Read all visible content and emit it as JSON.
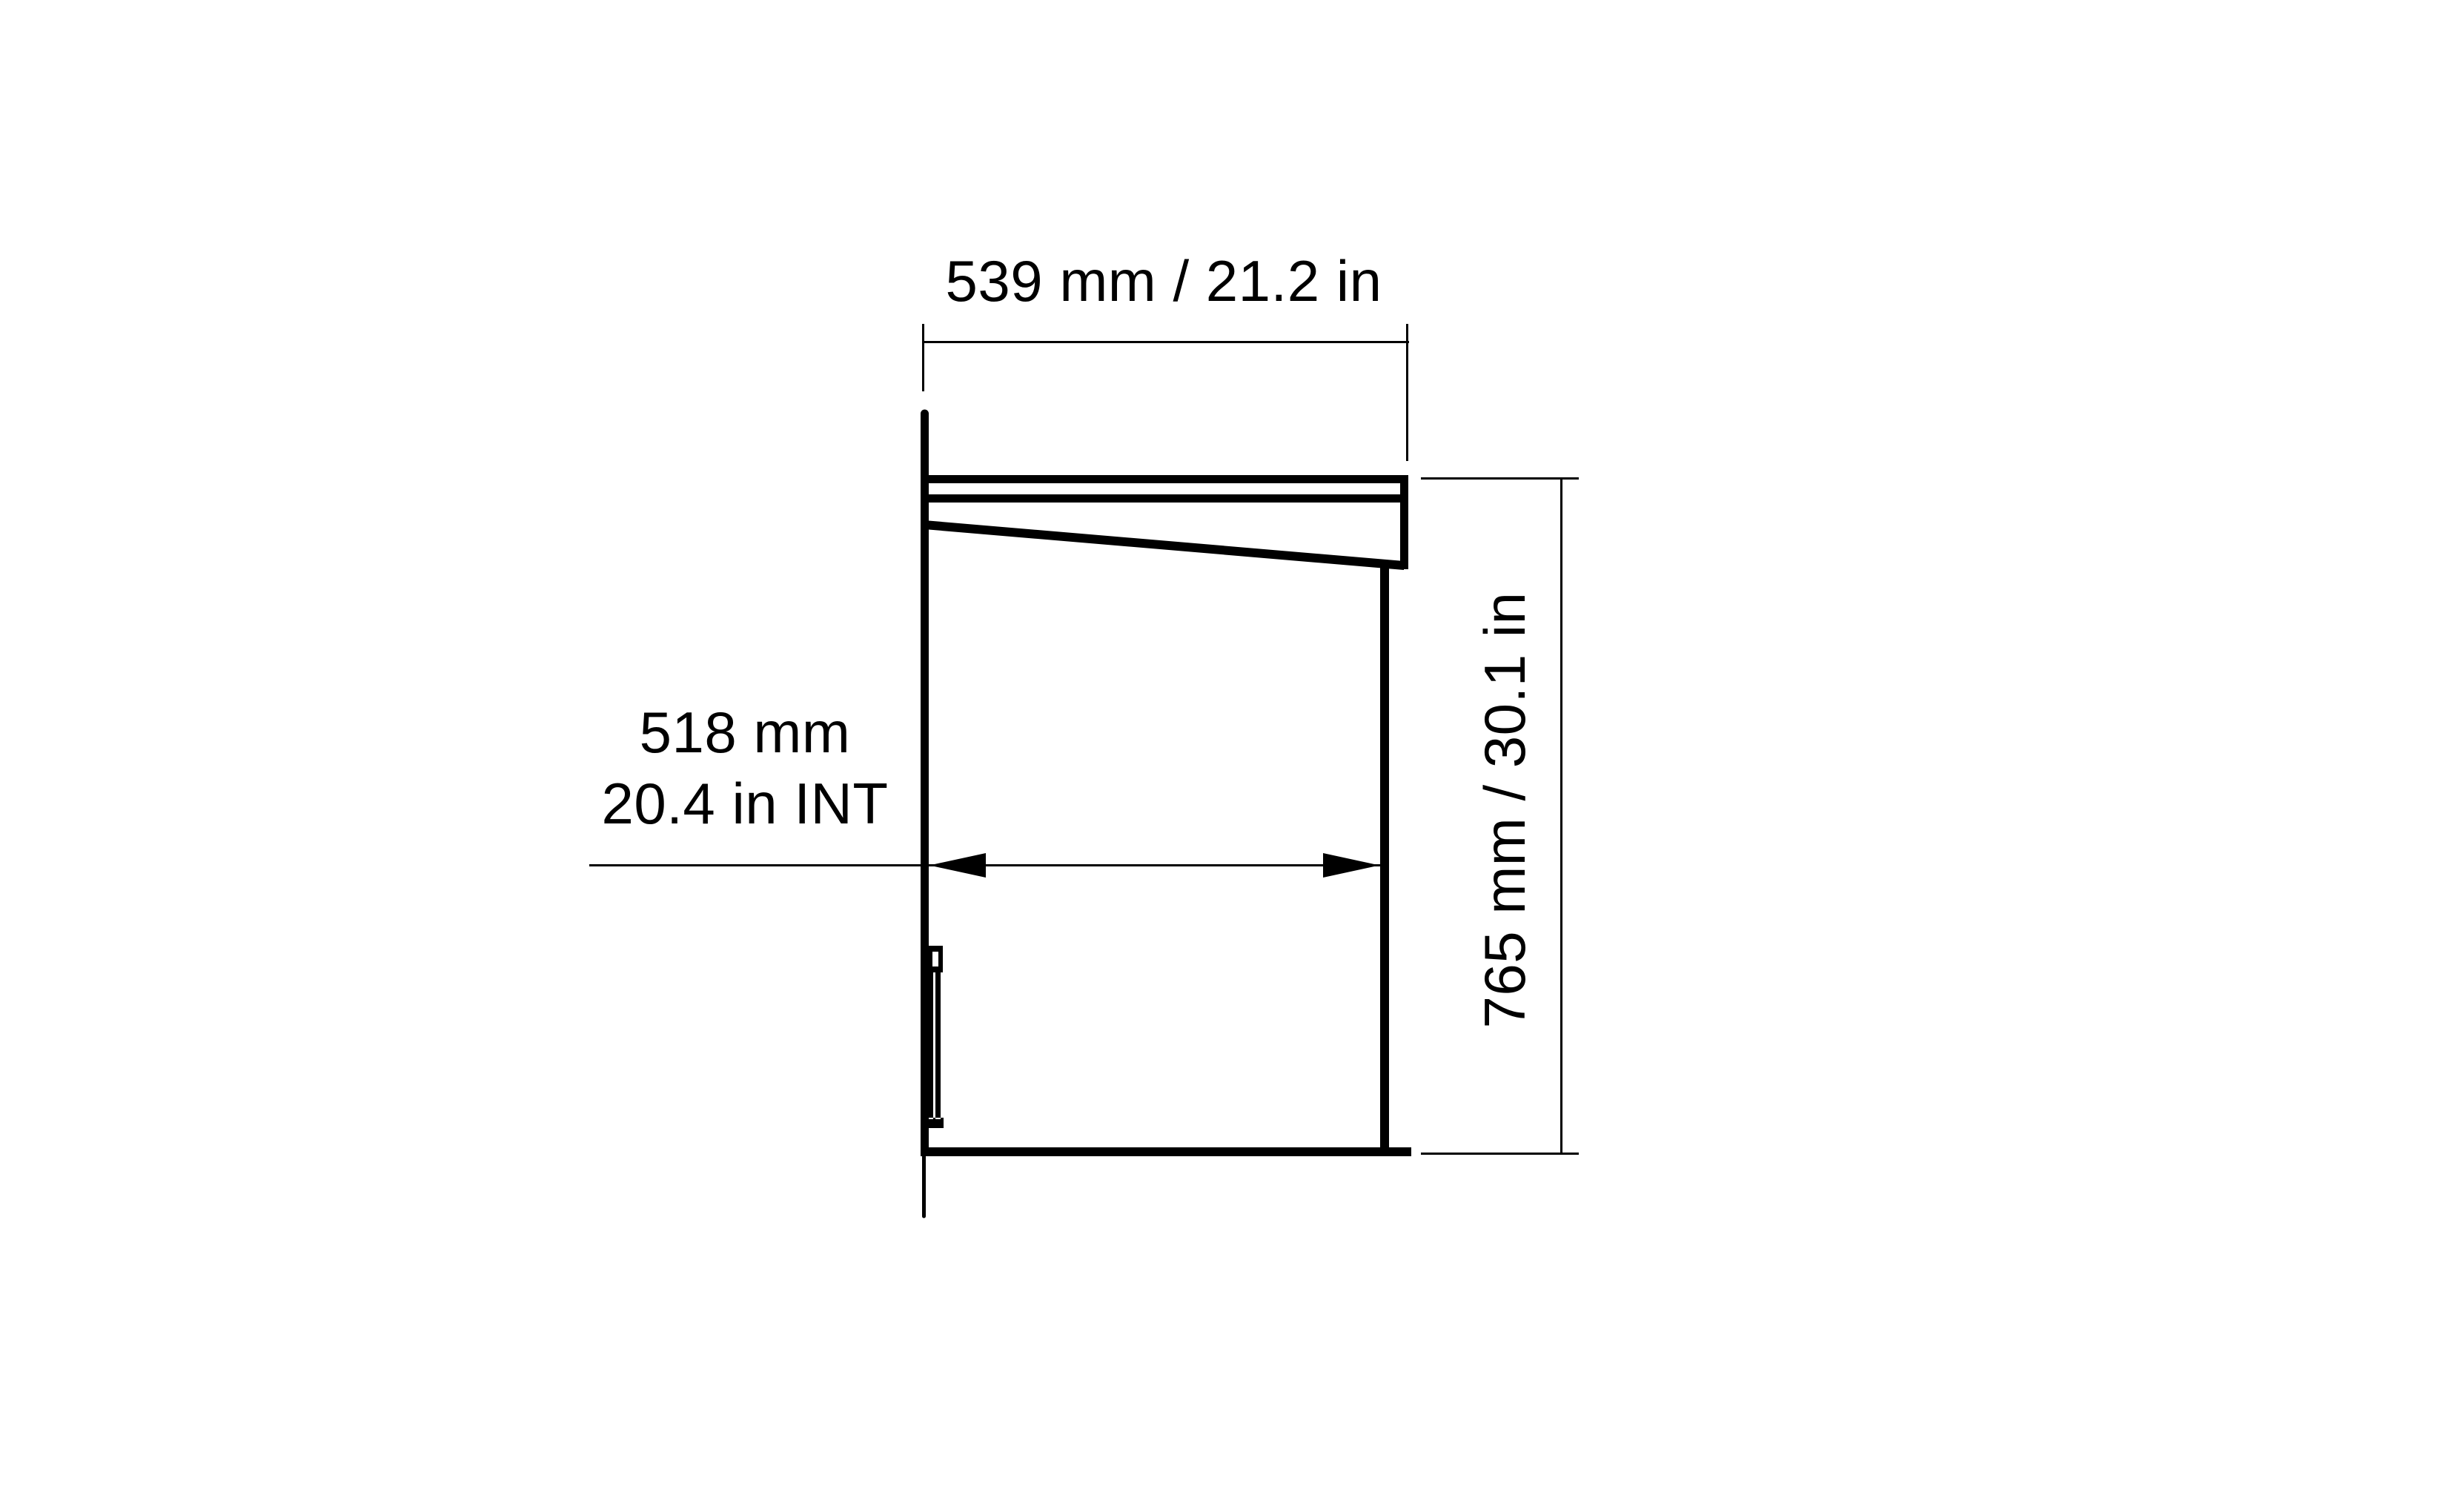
{
  "meta": {
    "colors": {
      "line": "#000000",
      "background": "#ffffff"
    }
  },
  "diagram": {
    "kind": "technical dimension drawing, side elevation of wall-mounted cabinet",
    "labels": {
      "top_width": "539 mm / 21.2 in",
      "internal_depth_line1": "518 mm",
      "internal_depth_line2": "20.4 in INT",
      "height": "765 mm / 30.1 in"
    }
  }
}
